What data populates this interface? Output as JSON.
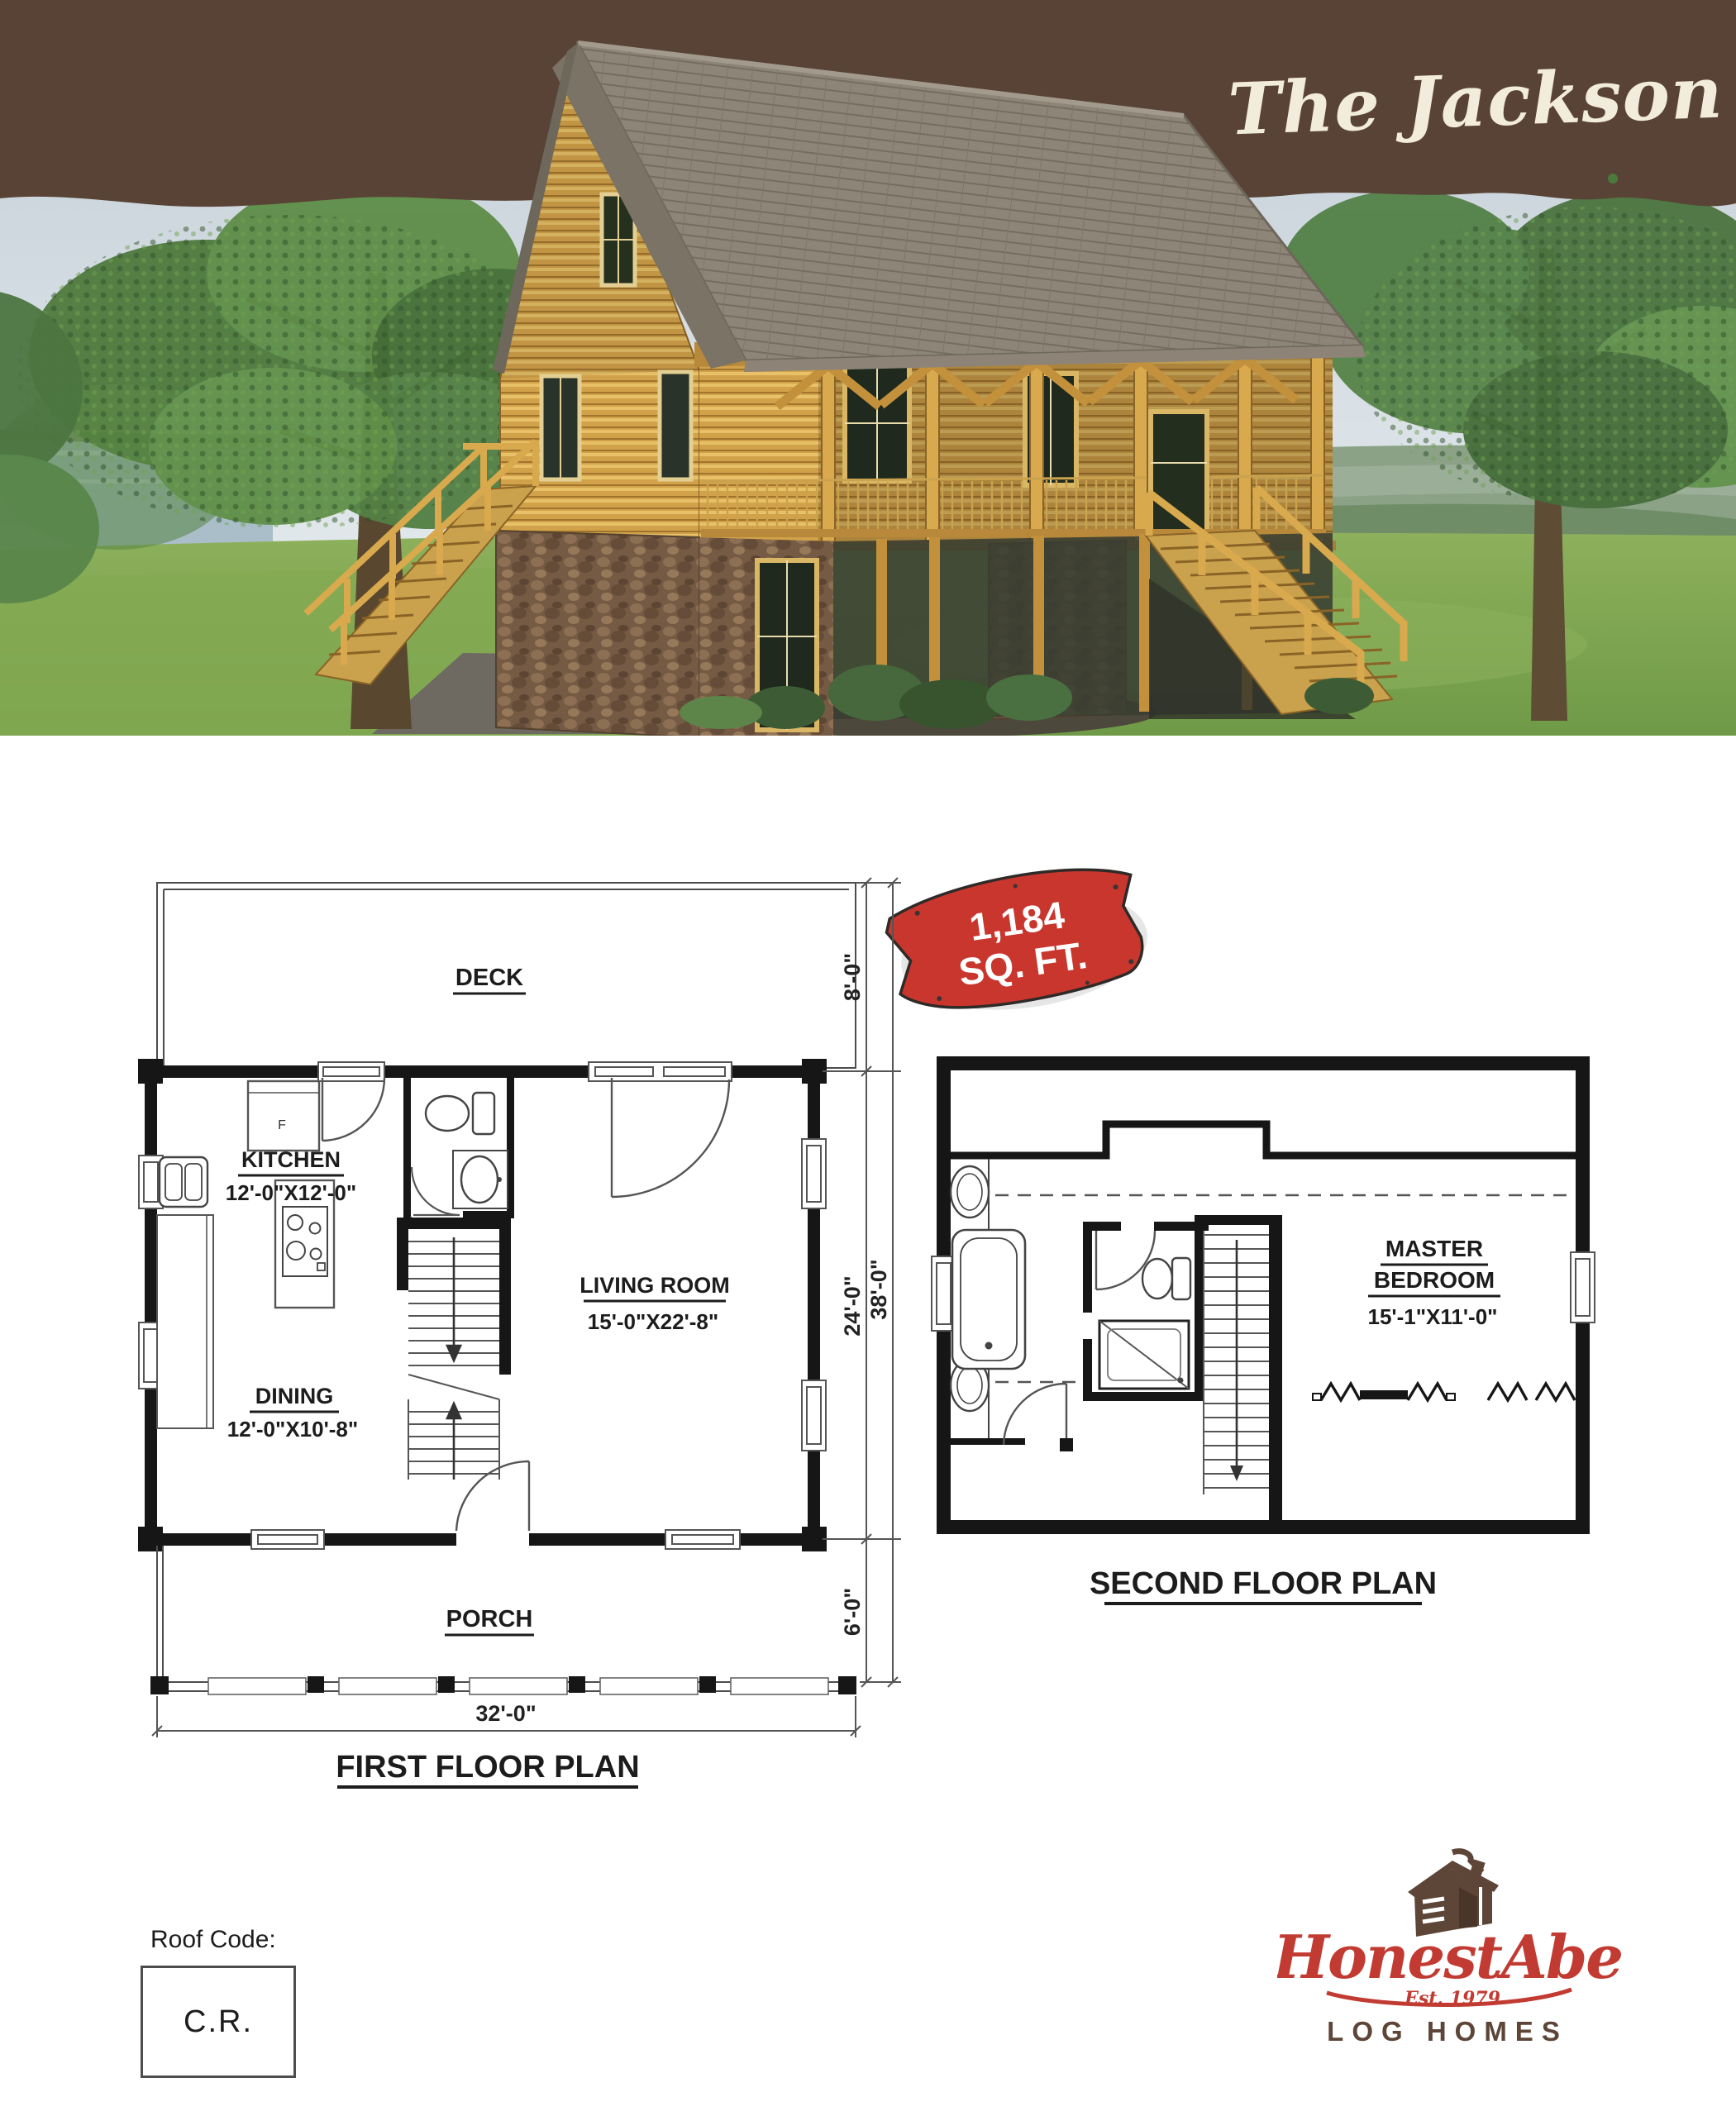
{
  "header": {
    "title": "The Jackson",
    "banner_color": "#594336"
  },
  "badge": {
    "line1": "1,184",
    "line2": "SQ. FT.",
    "color": "#c9362e"
  },
  "first_floor": {
    "title": "FIRST FLOOR PLAN",
    "deck_label": "DECK",
    "porch_label": "PORCH",
    "kitchen_name": "KITCHEN",
    "kitchen_dims": "12'-0\"X12'-0\"",
    "dining_name": "DINING",
    "dining_dims": "12'-0\"X10'-8\"",
    "living_name": "LIVING ROOM",
    "living_dims": "15'-0\"X22'-8\"",
    "fridge_label": "F",
    "dims": {
      "deck_depth": "8'-0\"",
      "main_depth": "24'-0\"",
      "overall_depth": "38'-0\"",
      "porch_depth": "6'-0\"",
      "overall_width": "32'-0\""
    }
  },
  "second_floor": {
    "title": "SECOND FLOOR PLAN",
    "master_line1": "MASTER",
    "master_line2": "BEDROOM",
    "master_dims": "15'-1\"X11'-0\""
  },
  "roof_code": {
    "label": "Roof Code:",
    "value": "C.R."
  },
  "logo": {
    "script": "HonestAbe",
    "est": "Est. 1979",
    "sub": "LOG HOMES",
    "red": "#c23b32",
    "brown": "#5d4537"
  }
}
